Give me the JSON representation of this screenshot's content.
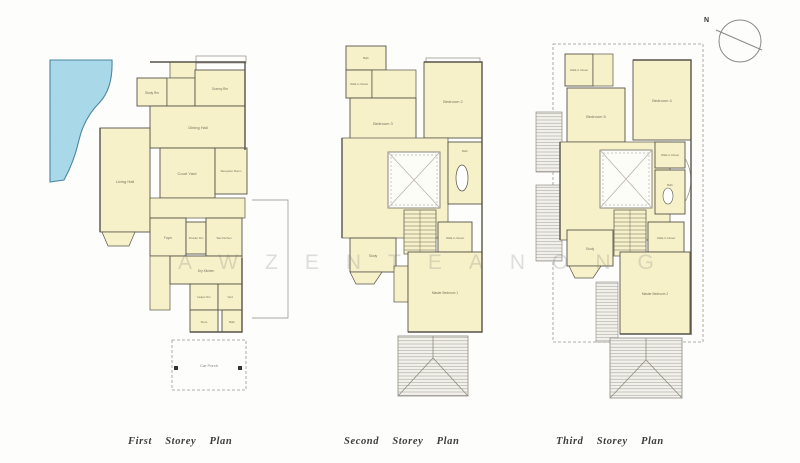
{
  "sheet": {
    "background": "#fdfdfb"
  },
  "watermark": {
    "text": "AWZENTEANONG"
  },
  "compass": {
    "label": "N"
  },
  "colors": {
    "room_fill": "#f6f1c9",
    "wall": "#57534a",
    "pool": "#a9d9e9",
    "pool_edge": "#4b86a0",
    "hatch": "#a9a59c",
    "dashed_roof": "#9a968c",
    "title": "#3f3d3a",
    "label": "#6a6352"
  },
  "plans": [
    {
      "title": "First Storey Plan",
      "rooms": {
        "study": "Study Rm",
        "granny": "Granny Rm",
        "dining": "Dining Hall",
        "living": "Living Hall",
        "court": "Court Yard",
        "reception": "Reception Room",
        "foyer": "Foyer",
        "powder": "Powder Rm",
        "wet_kitchen": "Wet Kitchen",
        "dry_kitchen": "Dry Kitchen",
        "helper": "Helper Rm",
        "yard": "Yard",
        "store": "Store",
        "bath": "Bath",
        "car_porch": "Car Porch"
      }
    },
    {
      "title": "Second Storey Plan",
      "rooms": {
        "bath_top": "Bath",
        "walkin_top": "Walk-in Closet",
        "bedroom3": "Bedroom 3",
        "bedroom2": "Bedroom 2",
        "bath_mid": "Bath",
        "study": "Study",
        "walkin_mid": "Walk-in Closet",
        "master": "Master Bedroom 1"
      }
    },
    {
      "title": "Third Storey Plan",
      "rooms": {
        "walkin_top": "Walk-in Closet",
        "bedroom5": "Bedroom 5",
        "bedroom4": "Bedroom 4",
        "walkin_mid": "Walk-in Closet",
        "bath": "Bath",
        "study": "Study",
        "walkin_low": "Walk-in Closet",
        "master": "Master Bedroom 2"
      }
    }
  ]
}
